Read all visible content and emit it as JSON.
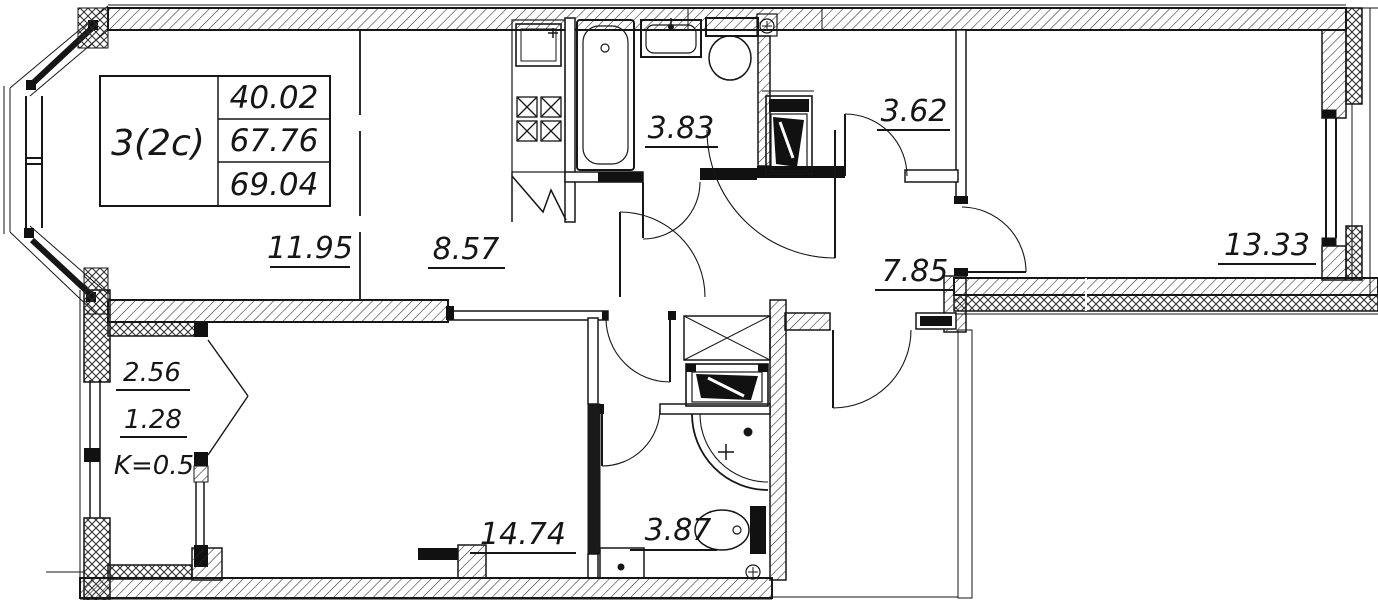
{
  "plan_title": {
    "unit": "3(2c)",
    "areas": [
      "40.02",
      "67.76",
      "69.04"
    ]
  },
  "rooms": [
    {
      "name": "living-room",
      "area": "11.95"
    },
    {
      "name": "kitchen",
      "area": "8.57"
    },
    {
      "name": "bathroom",
      "area": "3.83"
    },
    {
      "name": "storage",
      "area": "3.62"
    },
    {
      "name": "hall",
      "area": "7.85"
    },
    {
      "name": "room-right",
      "area": "13.33"
    },
    {
      "name": "bedroom",
      "area": "14.74"
    },
    {
      "name": "bathroom-2",
      "area": "3.87"
    }
  ],
  "balcony": {
    "area_full": "2.56",
    "area_reduced": "1.28",
    "coefficient": "K=0.5"
  },
  "fixtures": [
    "kitchen-sink",
    "stove",
    "refrigerator-niche",
    "bathtub",
    "washbasin",
    "toilet",
    "ventilation",
    "washing-machine",
    "wardrobe",
    "corner-washbasin",
    "radiator"
  ],
  "colors": {
    "line": "#1a1a1a",
    "wall_dark": "#111111",
    "background": "#ffffff"
  }
}
